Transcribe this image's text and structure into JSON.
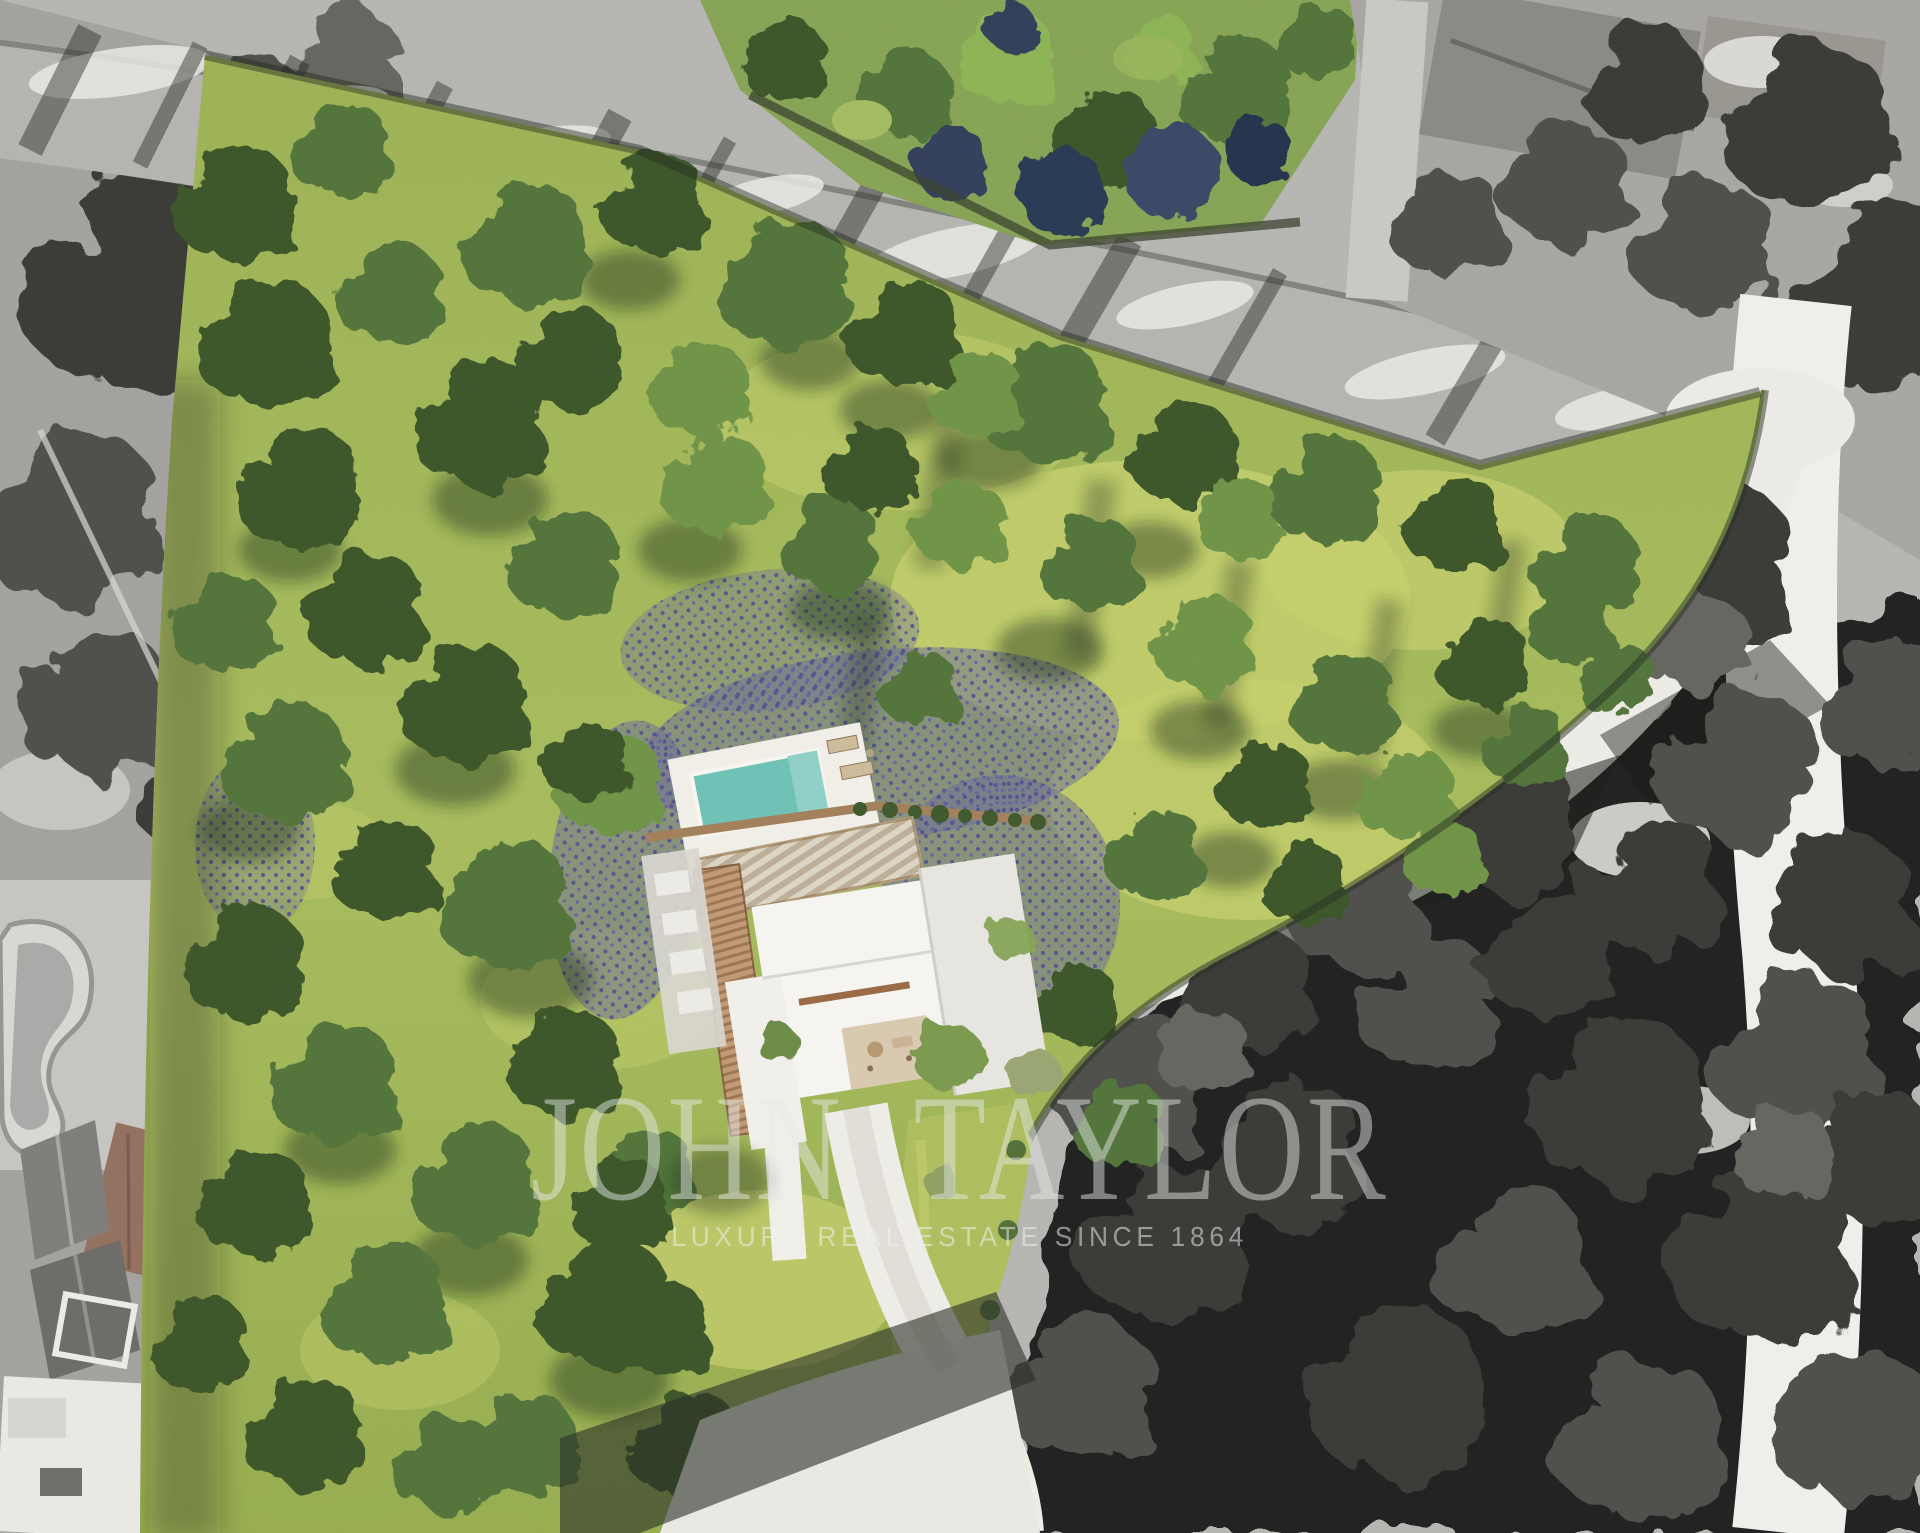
{
  "scene": {
    "kind": "aerial-property-rendering",
    "description": "Top-down aerial rendering of a wooded building plot shown in colour while all neighbouring villas, roads and woodland are desaturated to black and white. A modern white villa with a turquoise pool sits in the middle of the plot.",
    "watermark": {
      "brand": "JOHN TAYLOR",
      "tagline": "LUXURY REAL ESTATE SINCE 1864"
    },
    "palette": {
      "plot_grass": "#a4b95c",
      "meadow_highlight": "#c6cf6e",
      "canopy_dark": "#3c572b",
      "canopy_light": "#8cb455",
      "lavender": "#6a6a98",
      "pool_water": "#6fc2b6",
      "pool_deck": "#f0eee7",
      "villa_roof": "#f5f4f0",
      "pergola_wood": "#ddd5c4",
      "terracotta_ramp": "#c09a74",
      "driveway_white": "#edece7",
      "road_grey": "#b5b4b1",
      "road_white": "#efeeea",
      "bw_tree_dark": "#232321",
      "bw_ground": "#b6b5b2"
    }
  }
}
